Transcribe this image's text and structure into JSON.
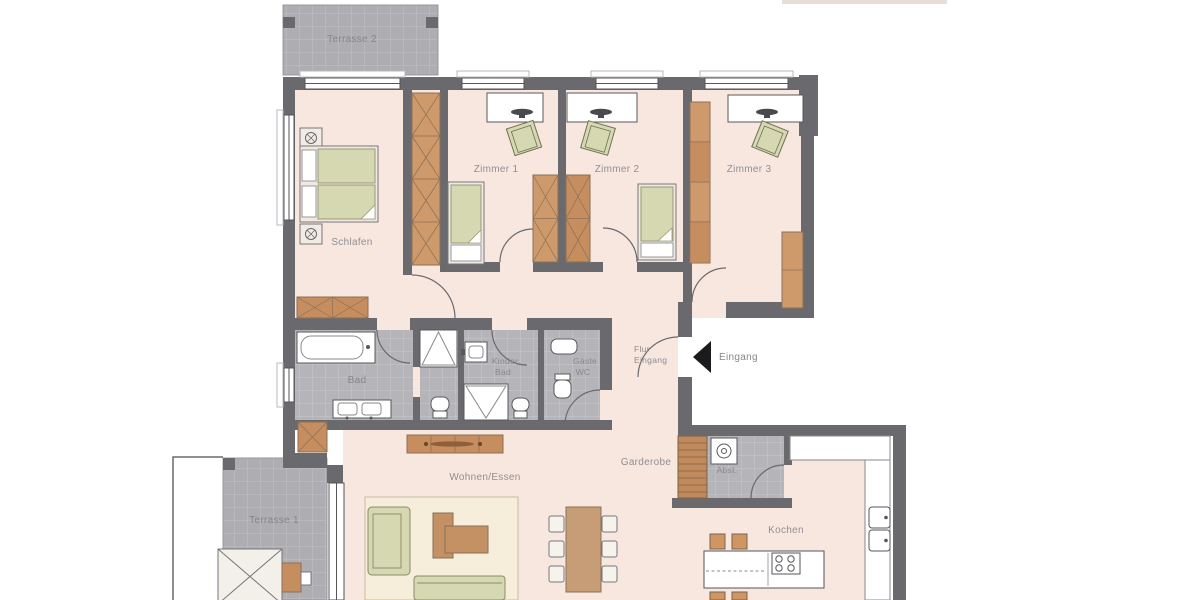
{
  "page": {
    "background": "#ffffff",
    "type": "architectural floor plan"
  },
  "labels": {
    "terrasse2": "Terrasse 2",
    "terrasse1": "Terrasse 1",
    "schlafen": "Schlafen",
    "zimmer1": "Zimmer 1",
    "zimmer2": "Zimmer 2",
    "zimmer3": "Zimmer 3",
    "bad": "Bad",
    "kinderbad_l1": "Kinder",
    "kinderbad_l2": "Bad",
    "gaestewc_l1": "Gäste",
    "gaestewc_l2": "WC",
    "flur_l1": "Flur",
    "flur_l2": "Eingang",
    "eingang": "Eingang",
    "garderobe": "Garderobe",
    "abst": "Abst.",
    "wohnen_essen": "Wohnen/Essen",
    "kochen": "Kochen"
  },
  "colors": {
    "wall": "#6a6a6e",
    "floor_pink": "#f8e7df",
    "tile_gray": "#b5b5b9",
    "tile_line": "#c9c9cd",
    "furniture_brown": "#c68d5f",
    "furniture_brown_light": "#cf9a6b",
    "mattress_green": "#d5d8b0",
    "rug_cream": "#f6eeda",
    "label_gray": "#8f8f94",
    "entrance_arrow": "#1b1b1d"
  }
}
